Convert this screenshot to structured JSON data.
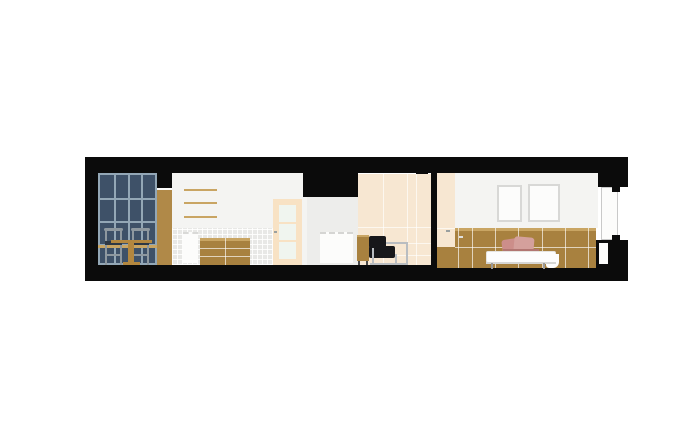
{
  "title": "residential-longitudinal-section-drawing",
  "palette": {
    "background": "#ffffff",
    "paper_white": "#fcfcfb",
    "structure_black": "#0b0b0b",
    "window_glass": "#3e5168",
    "window_mullion": "#93a7b6",
    "wood_medium": "#a8813f",
    "wood_column": "#b08948",
    "wood_light_rail": "#c9a563",
    "wall_white": "#f4f4f2",
    "tile_gray": "#e8e8e6",
    "cream_panel": "#f7e7d2",
    "door_cream": "#f8e2c4",
    "door_glass": "#f0f5ef",
    "fireplace_gray": "#ededeb",
    "chair_black": "#17171a",
    "chair_frame": "#8e989f",
    "chair_seat": "#2e3844",
    "chrome": "#b9bdc1",
    "pillow_pink": "#cc8e8a",
    "pillow_pink_light": "#d4a09c",
    "pillow_pink_dark": "#b27672",
    "bedding_white": "#fdfdfd",
    "frame_border": "#d8d8d6",
    "table_wood": "#b3873f"
  },
  "scene_facts": {
    "glazing_grid_columns": 4,
    "glazing_grid_rows": 4,
    "kitchen_shelves": 3,
    "dining_chairs": 2,
    "picture_frames": 2,
    "pillows": 2,
    "rooms_in_section": 3
  }
}
